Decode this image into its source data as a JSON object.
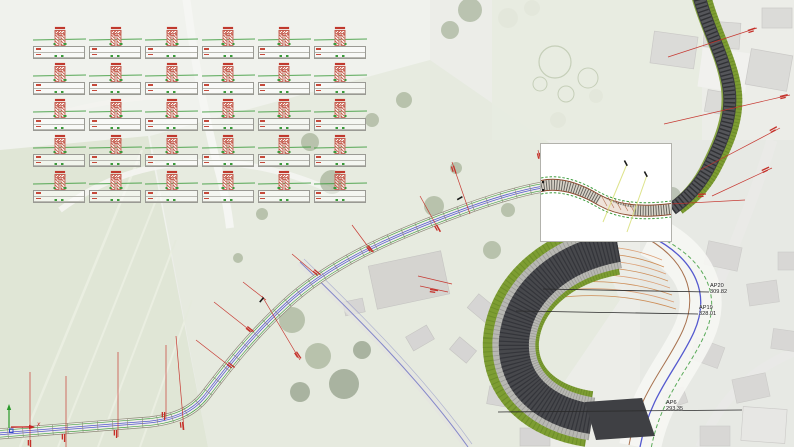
{
  "markers": {
    "ap20": {
      "name": "AP20",
      "station": "309.82"
    },
    "ap19": {
      "name": "AP19",
      "station": "328.01"
    },
    "ap6": {
      "name": "AP6",
      "station": "293.35"
    }
  },
  "ucs": {
    "x_label": "x"
  },
  "cross_sections": {
    "rows": 5,
    "cols": 6
  },
  "colors": {
    "annotation_red": "#c5312a",
    "design_green": "#3f9e3f",
    "axis_blue": "#5459cf",
    "embankment_green": "#7d9d32",
    "asphalt": "#47484c",
    "terrace_orange": "#c87c3e",
    "leader_black": "#2a2a2a"
  }
}
